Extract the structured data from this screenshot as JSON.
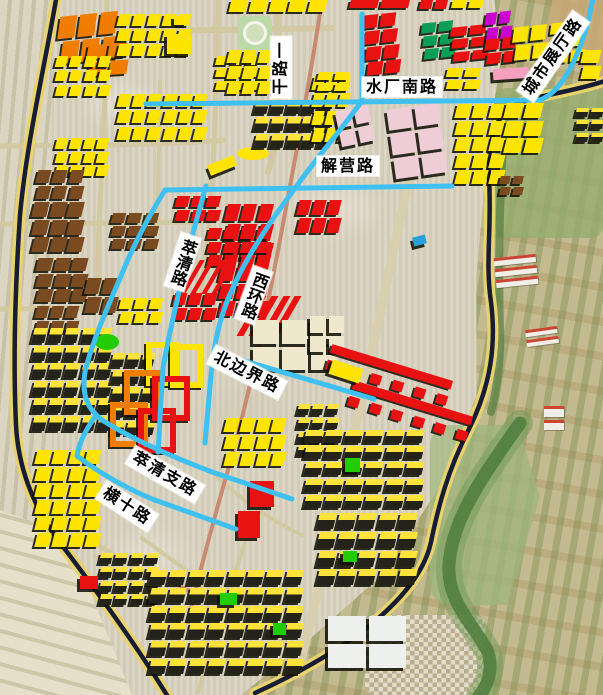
{
  "map_title": "urban plan satellite map with road name overlay",
  "road_labels": [
    {
      "id": "ganlu-yi",
      "text": "干路一",
      "cx": 281,
      "cy": 67,
      "rot": -90,
      "mode": "h"
    },
    {
      "id": "shuichang-nanlu",
      "text": "水厂南路",
      "cx": 402,
      "cy": 87,
      "rot": 0,
      "mode": "h"
    },
    {
      "id": "chengshi-zhanting-lu",
      "text": "城市展厅路",
      "cx": 553,
      "cy": 56,
      "rot": -55,
      "mode": "h"
    },
    {
      "id": "jieying-lu",
      "text": "解营路",
      "cx": 348,
      "cy": 166,
      "rot": 0,
      "mode": "h"
    },
    {
      "id": "cuiqing-lu",
      "text": "萃清路",
      "cx": 182,
      "cy": 262,
      "rot": 18,
      "mode": "v"
    },
    {
      "id": "xihuan-lu",
      "text": "西环路",
      "cx": 253,
      "cy": 295,
      "rot": 20,
      "mode": "v"
    },
    {
      "id": "beibianjie-lu",
      "text": "北边界路",
      "cx": 247,
      "cy": 372,
      "rot": 27,
      "mode": "h"
    },
    {
      "id": "cuiqing-zhilu",
      "text": "萃清支路",
      "cx": 165,
      "cy": 474,
      "rot": 30,
      "mode": "h"
    },
    {
      "id": "hengshi-lu",
      "text": "横十路",
      "cx": 127,
      "cy": 506,
      "rot": 33,
      "mode": "h"
    }
  ],
  "palette": {
    "yellow": "#ffe400",
    "yellowS": "#ffe400",
    "red": "#e81212",
    "orange": "#ef7d00",
    "brown": "#7a4a20",
    "teal": "#0b9e57",
    "magenta": "#cc00cc",
    "green": "#22cc00",
    "pinkS": "#f6a0c0",
    "palepink": "#eecdd6",
    "cream": "#f0e8cc",
    "white": "#eef0ee",
    "blueB": "#2a9fd8",
    "dy": "dark-yellow",
    "farm": "#f0eee6"
  },
  "road_colors": {
    "tan": "#d2c8a2",
    "tan_wide": "#d8cfae",
    "salmon": "#c98a72",
    "navy_casing": "#e8d36f",
    "navy_core": "#171d32",
    "blue": "#3fc0f1",
    "river": "#4e7d3c",
    "river_halo": "#6f9a55",
    "trees": "#567f3f"
  },
  "roads": {
    "tan": [
      {
        "d": "M55,33 C150,30 250,30 332,28",
        "w": 6
      },
      {
        "d": "M0,146 L110,145 C160,144 200,142 224,140",
        "w": 5
      },
      {
        "d": "M0,224 L202,222",
        "w": 5
      },
      {
        "d": "M0,309 L152,308",
        "w": 5
      },
      {
        "d": "M107,0 L106,60 C105,100 104,120 103,146 C100,200 98,250 96,308",
        "w": 5
      },
      {
        "d": "M218,0 C217,60 216,100 214,146 C212,200 208,250 200,300",
        "w": 5
      },
      {
        "d": "M278,0 L279,100 C279,130 275,152 268,172",
        "w": 6
      },
      {
        "d": "M160,82 L159,146 L157,225",
        "w": 4
      },
      {
        "d": "M428,88 C408,180 390,270 370,360 C355,430 335,520 300,665",
        "w": 9,
        "c": "tan_wide"
      },
      {
        "d": "M60,518 C110,555 150,580 205,597 C240,607 270,610 302,612",
        "w": 5
      },
      {
        "d": "M210,470 C240,500 270,520 302,535",
        "w": 4
      },
      {
        "d": "M95,555 L250,675",
        "w": 4
      },
      {
        "d": "M142,538 L302,655",
        "w": 4
      },
      {
        "d": "M248,532 L198,692",
        "w": 4
      }
    ],
    "salmon": [
      {
        "d": "M322,0 C310,80 295,160 280,240 C265,320 248,400 228,470 C215,515 200,570 188,622",
        "w": 4
      },
      {
        "d": "M160,573 C175,585 190,592 204,596",
        "w": 4
      }
    ],
    "navy": [
      {
        "d": "M57,-6 C44,70 27,140 20,215 C15,290 13,360 16,425 C18,465 32,505 58,540 C88,580 128,632 170,700"
      },
      {
        "d": "M608,80 C570,93 535,95 515,105 C494,116 488,142 489,178 C492,228 485,262 491,302 C496,342 492,383 469,429 C447,472 438,508 431,542 C420,592 360,645 255,693"
      }
    ],
    "blue": [
      {
        "d": "M146,104 L540,100"
      },
      {
        "d": "M540,100 C562,92 578,58 588,22 L593,-2"
      },
      {
        "d": "M362,14 L362,100"
      },
      {
        "d": "M362,101 C338,134 314,161 296,187 C268,224 243,262 228,299 C217,326 213,352 211,375 L205,443"
      },
      {
        "d": "M165,190 L452,186"
      },
      {
        "d": "M165,190 C149,216 133,246 121,276 C104,315 91,346 85,372 C81,397 89,410 102,420"
      },
      {
        "d": "M102,420 C135,441 175,458 212,472 L292,499"
      },
      {
        "d": "M96,415 C86,430 79,442 77,456"
      },
      {
        "d": "M77,456 C98,472 124,487 152,499 L236,529"
      },
      {
        "d": "M214,352 L374,399"
      },
      {
        "d": "M206,186 L194,229 C182,278 170,328 163,368 L158,452"
      }
    ],
    "river": {
      "d": "M520,423 C480,480 452,520 449,565 C447,600 470,620 487,650 C495,670 486,688 479,696"
    },
    "trees": {
      "d": "M505,118 C500,180 498,260 500,330 C501,360 497,390 491,412"
    }
  },
  "building_clusters": [
    [
      60,
      14,
      58,
      46,
      "orange",
      2,
      3,
      -6
    ],
    [
      88,
      44,
      38,
      30,
      "orange",
      2,
      2,
      -4
    ],
    [
      118,
      14,
      72,
      42,
      "yellow",
      3,
      5,
      0
    ],
    [
      56,
      56,
      54,
      40,
      "yellow",
      3,
      4,
      0
    ],
    [
      118,
      94,
      88,
      46,
      "yellow",
      3,
      6,
      0
    ],
    [
      216,
      56,
      44,
      34,
      "yellow",
      3,
      3,
      0
    ],
    [
      56,
      138,
      52,
      38,
      "yellow",
      3,
      4,
      0
    ],
    [
      230,
      0,
      96,
      12,
      "yellow",
      1,
      5,
      0
    ],
    [
      350,
      0,
      58,
      8,
      "red",
      1,
      2,
      0
    ],
    [
      420,
      0,
      26,
      9,
      "red",
      1,
      2,
      0
    ],
    [
      452,
      0,
      30,
      8,
      "yellow",
      1,
      2,
      0
    ],
    [
      167,
      34,
      24,
      20,
      "yellowS",
      1,
      1,
      0,
      "solid"
    ],
    [
      174,
      16,
      13,
      9,
      "yellowS",
      1,
      1,
      0,
      "solid"
    ],
    [
      237,
      147,
      32,
      13,
      "yellowS",
      1,
      1,
      0,
      "ellipse"
    ],
    [
      208,
      160,
      28,
      11,
      "yellowS",
      1,
      1,
      -22,
      "solid"
    ],
    [
      238,
      16,
      34,
      34,
      "park",
      0,
      0,
      0,
      "park"
    ],
    [
      228,
      50,
      58,
      44,
      "yellow",
      3,
      4,
      0
    ],
    [
      255,
      100,
      76,
      48,
      "dy",
      3,
      5,
      0
    ],
    [
      313,
      76,
      36,
      66,
      "yellow",
      4,
      3,
      0
    ],
    [
      37,
      170,
      46,
      28,
      "brown",
      2,
      3,
      0
    ],
    [
      33,
      202,
      50,
      50,
      "brown",
      3,
      3,
      0
    ],
    [
      112,
      213,
      46,
      36,
      "brown",
      3,
      3,
      0
    ],
    [
      37,
      258,
      50,
      44,
      "brown",
      3,
      3,
      0
    ],
    [
      36,
      306,
      42,
      26,
      "brown",
      2,
      3,
      0
    ],
    [
      86,
      278,
      30,
      34,
      "brown",
      2,
      2,
      0
    ],
    [
      120,
      298,
      42,
      24,
      "yellow",
      2,
      3,
      0
    ],
    [
      33,
      328,
      78,
      102,
      "dy",
      6,
      5,
      0
    ],
    [
      112,
      353,
      42,
      82,
      "dy",
      5,
      3,
      0
    ],
    [
      95,
      334,
      24,
      16,
      "green",
      1,
      1,
      0,
      "ellipse"
    ],
    [
      365,
      14,
      32,
      60,
      "red",
      4,
      2,
      -6
    ],
    [
      423,
      22,
      30,
      36,
      "teal",
      3,
      2,
      -6
    ],
    [
      452,
      26,
      34,
      34,
      "red",
      3,
      2,
      -6
    ],
    [
      486,
      12,
      25,
      26,
      "magenta",
      2,
      2,
      -6
    ],
    [
      486,
      38,
      30,
      24,
      "red",
      2,
      2,
      -6
    ],
    [
      514,
      26,
      32,
      32,
      "yellow",
      2,
      2,
      -6
    ],
    [
      552,
      22,
      30,
      40,
      "yellow",
      3,
      2,
      -6
    ],
    [
      582,
      50,
      18,
      28,
      "yellow",
      2,
      1,
      0
    ],
    [
      493,
      68,
      36,
      11,
      "pinkS",
      1,
      1,
      -4,
      "solid"
    ],
    [
      447,
      68,
      32,
      20,
      "yellow",
      2,
      2,
      0
    ],
    [
      318,
      72,
      30,
      18,
      "yellow",
      2,
      2,
      0
    ],
    [
      338,
      108,
      34,
      36,
      "palepink",
      2,
      2,
      -12,
      "big"
    ],
    [
      391,
      106,
      52,
      70,
      "palepink",
      3,
      2,
      -8,
      "big"
    ],
    [
      456,
      104,
      48,
      80,
      "yellow",
      5,
      3,
      0
    ],
    [
      505,
      103,
      36,
      50,
      "yellow",
      3,
      2,
      0
    ],
    [
      576,
      108,
      26,
      34,
      "dy",
      3,
      2,
      0
    ],
    [
      500,
      176,
      22,
      18,
      "brown",
      2,
      2,
      0
    ],
    [
      176,
      196,
      44,
      24,
      "red",
      2,
      3,
      0
    ],
    [
      226,
      204,
      46,
      56,
      "red",
      3,
      3,
      0
    ],
    [
      208,
      228,
      62,
      38,
      "red",
      3,
      4,
      0
    ],
    [
      220,
      266,
      47,
      50,
      "red",
      3,
      3,
      0
    ],
    [
      174,
      293,
      42,
      26,
      "red",
      2,
      3,
      0
    ],
    [
      190,
      260,
      36,
      34,
      "red",
      1,
      4,
      0,
      "slash"
    ],
    [
      248,
      296,
      42,
      40,
      "red",
      1,
      4,
      0,
      "slash"
    ],
    [
      298,
      200,
      42,
      32,
      "red",
      2,
      3,
      0
    ],
    [
      413,
      236,
      13,
      9,
      "blueB",
      1,
      1,
      -14,
      "solid"
    ],
    [
      146,
      342,
      21,
      32,
      "yellowS",
      1,
      1,
      0,
      "court"
    ],
    [
      170,
      344,
      21,
      32,
      "yellowS",
      1,
      1,
      0,
      "court"
    ],
    [
      124,
      370,
      26,
      33,
      "orange",
      1,
      1,
      0,
      "court"
    ],
    [
      152,
      376,
      26,
      33,
      "red",
      1,
      1,
      0,
      "court"
    ],
    [
      110,
      402,
      26,
      33,
      "orange",
      1,
      1,
      0,
      "court"
    ],
    [
      138,
      408,
      26,
      33,
      "red",
      1,
      1,
      0,
      "court"
    ],
    [
      253,
      320,
      84,
      50,
      "cream",
      2,
      3,
      0,
      "big"
    ],
    [
      310,
      316,
      34,
      36,
      "cream",
      2,
      2,
      0,
      "big"
    ],
    [
      326,
      362,
      126,
      26,
      "red",
      0,
      0,
      17,
      "comb"
    ],
    [
      348,
      398,
      124,
      26,
      "red",
      0,
      0,
      17,
      "comb"
    ],
    [
      330,
      364,
      32,
      15,
      "yellowS",
      1,
      1,
      18,
      "solid"
    ],
    [
      298,
      404,
      40,
      52,
      "dy",
      4,
      3,
      0
    ],
    [
      225,
      418,
      60,
      48,
      "yellow",
      3,
      4,
      0
    ],
    [
      250,
      481,
      24,
      26,
      "red",
      1,
      1,
      0,
      "big"
    ],
    [
      238,
      511,
      22,
      27,
      "red",
      1,
      1,
      0,
      "big"
    ],
    [
      36,
      450,
      64,
      96,
      "yellow",
      6,
      4,
      0
    ],
    [
      100,
      553,
      58,
      52,
      "dy",
      4,
      4,
      0
    ],
    [
      80,
      576,
      18,
      13,
      "red",
      1,
      1,
      0,
      "solid"
    ],
    [
      150,
      570,
      152,
      104,
      "dy",
      6,
      8,
      0
    ],
    [
      305,
      430,
      118,
      78,
      "dy",
      5,
      6,
      0
    ],
    [
      318,
      513,
      98,
      72,
      "dy",
      4,
      5,
      0
    ],
    [
      345,
      458,
      15,
      14,
      "green",
      1,
      1,
      0,
      "solid"
    ],
    [
      343,
      551,
      14,
      11,
      "green",
      1,
      1,
      0,
      "solid"
    ],
    [
      220,
      593,
      17,
      12,
      "green",
      1,
      1,
      0,
      "solid"
    ],
    [
      273,
      623,
      13,
      12,
      "green",
      1,
      1,
      0,
      "solid"
    ],
    [
      495,
      256,
      42,
      30,
      "farm",
      3,
      1,
      -6,
      "farm"
    ],
    [
      526,
      328,
      32,
      17,
      "farm",
      2,
      1,
      -8,
      "farm"
    ],
    [
      544,
      406,
      20,
      24,
      "farm",
      2,
      1,
      0,
      "farm"
    ],
    [
      328,
      616,
      78,
      52,
      "white",
      2,
      2,
      0,
      "big"
    ]
  ]
}
